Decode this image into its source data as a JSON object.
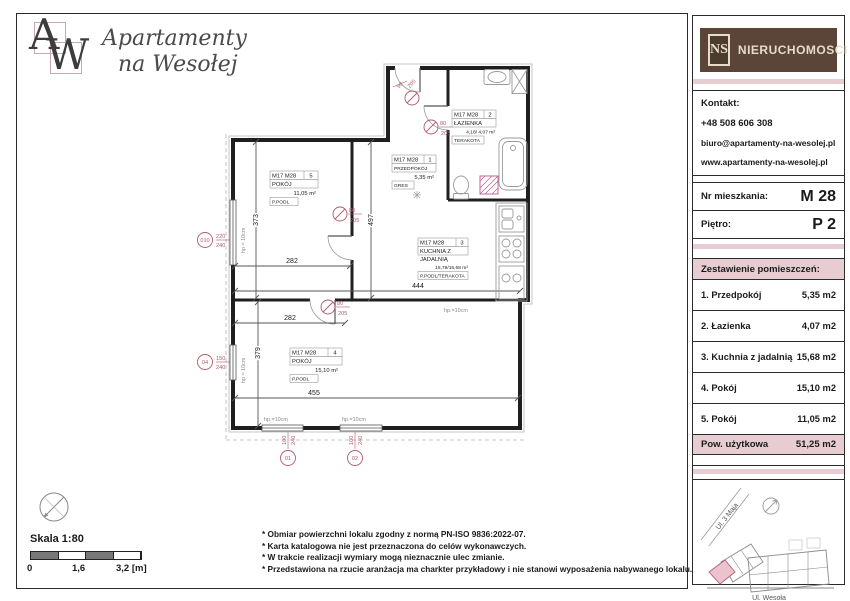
{
  "brand": {
    "monogram_a": "A",
    "monogram_w": "W",
    "name_line1": "Apartamenty",
    "name_line2": "na Wesołej"
  },
  "agency": {
    "abbr": "NS",
    "name": "NIERUCHOMOSCI"
  },
  "contact": {
    "heading": "Kontakt:",
    "phone": "+48 508 606 308",
    "email": "biuro@apartamenty-na-wesolej.pl",
    "website": "www.apartamenty-na-wesolej.pl"
  },
  "unit": {
    "number_label": "Nr mieszkania:",
    "number": "M 28",
    "floor_label": "Piętro:",
    "floor": "P 2"
  },
  "rooms_table": {
    "heading": "Zestawienie pomieszczeń:",
    "rows": [
      {
        "name": "1. Przedpokój",
        "area": "5,35 m2"
      },
      {
        "name": "2. Łazienka",
        "area": "4,07 m2"
      },
      {
        "name": "3. Kuchnia z jadalnią",
        "area": "15,68 m2"
      },
      {
        "name": "4. Pokój",
        "area": "15,10 m2"
      },
      {
        "name": "5. Pokój",
        "area": "11,05 m2"
      }
    ],
    "total_label": "Pow. użytkowa",
    "total_area": "51,25 m2"
  },
  "floor_plan": {
    "labels": [
      {
        "code": "M17 M28",
        "no": "5",
        "name": "POKÓJ",
        "area": "11,05 m²",
        "finish": "P.PODL"
      },
      {
        "code": "M17 M28",
        "no": "1",
        "name": "PRZEDPOKÓJ",
        "area": "5,35 m²",
        "finish": "GRES"
      },
      {
        "code": "M17 M28",
        "no": "2",
        "name": "ŁAZIENKA",
        "area": "4,18/ 4,07 m²",
        "finish": "TERAKOTA"
      },
      {
        "code": "M17 M28",
        "no": "3",
        "name_line1": "KUCHNIA Z",
        "name_line2": "JADALNIĄ",
        "area": "15,79/15,68 m²",
        "finish": "P.PODL/TERAKOTA"
      },
      {
        "code": "M17 M28",
        "no": "4",
        "name": "POKÓJ",
        "area": "15,10 m²",
        "finish": "P.PODL"
      }
    ],
    "dims": [
      "373",
      "282",
      "497",
      "444",
      "282",
      "379",
      "455"
    ],
    "doors": [
      {
        "w": "90",
        "h": "205"
      },
      {
        "w": "80",
        "h": "205"
      },
      {
        "w": "80",
        "h": "205"
      },
      {
        "w": "80",
        "h": "205"
      }
    ],
    "windows": [
      {
        "id": "010",
        "w": "220",
        "h": "240"
      },
      {
        "id": "04",
        "w": "150",
        "h": "240"
      },
      {
        "id": "01",
        "w": "100",
        "h": "240"
      },
      {
        "id": "02",
        "w": "100",
        "h": "240"
      }
    ],
    "hp_note": "hp = 10cm",
    "hp_note_short": "hp.=10cm"
  },
  "site_map": {
    "street_top": "Ul. 3 Maja",
    "street_bottom": "Ul. Wesoła"
  },
  "scale": {
    "label": "Skala 1:80",
    "ticks": [
      "0",
      "1,6",
      "3,2 [m]"
    ]
  },
  "notes": [
    "* Obmiar powierzchni lokalu zgodny z normą PN-ISO 9836:2022-07.",
    "* Karta katalogowa nie jest przeznaczona do celów wykonawczych.",
    "* W trakcie realizacji wymiary mogą nieznacznie ulec zmianie.",
    "* Przedstawiona na rzucie aranżacja ma charkter przykładowy i nie stanowi wyposażenia nabywanego lokalu."
  ],
  "colors": {
    "accent_pink": "#e7cdd2",
    "brand_brown": "#5a4538",
    "plan_accent": "#b05a6e",
    "highlight_pink": "#ecc3cd"
  }
}
